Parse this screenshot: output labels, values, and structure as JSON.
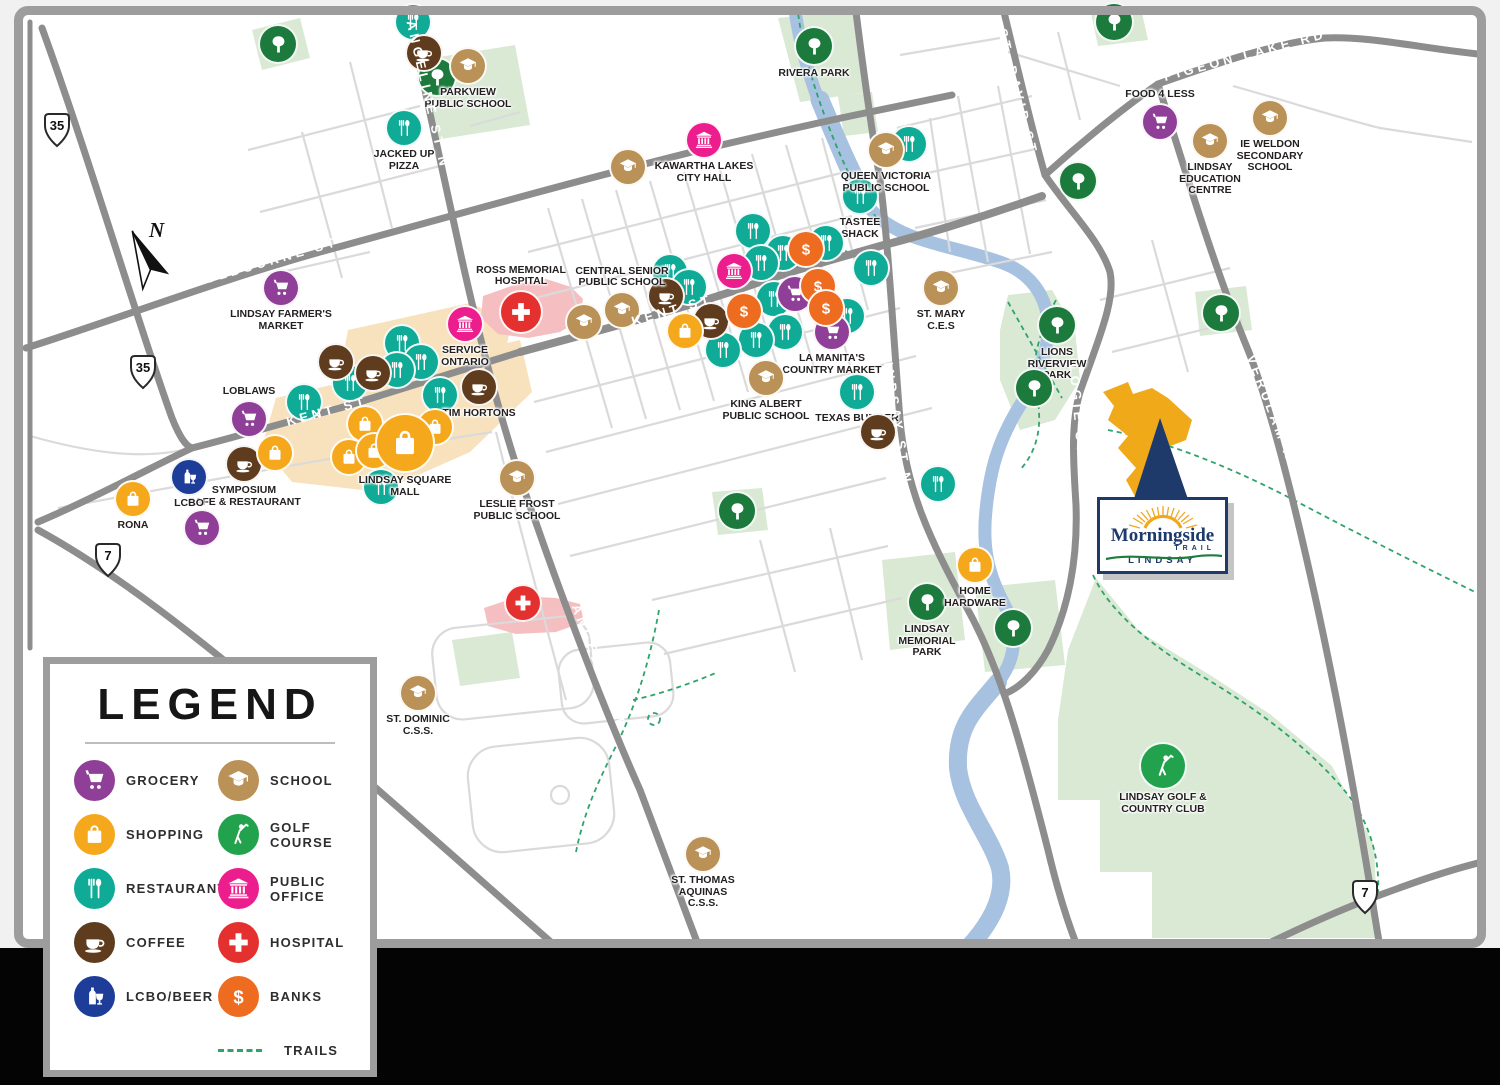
{
  "page": {
    "bottom_background": "black"
  },
  "legend": {
    "title": "LEGEND",
    "items": [
      {
        "type": "grocery",
        "label": "GROCERY"
      },
      {
        "type": "shopping",
        "label": "SHOPPING"
      },
      {
        "type": "restaurant",
        "label": "RESTAURANT"
      },
      {
        "type": "coffee",
        "label": "COFFEE"
      },
      {
        "type": "lcbo",
        "label": "LCBO/BEER"
      },
      {
        "type": "school",
        "label": "SCHOOL"
      },
      {
        "type": "golf",
        "label": "GOLF COURSE"
      },
      {
        "type": "public",
        "label": "PUBLIC OFFICE"
      },
      {
        "type": "hospital",
        "label": "HOSPITAL"
      },
      {
        "type": "bank",
        "label": "BANKS"
      }
    ],
    "trails_label": "TRAILS"
  },
  "logo": {
    "name": "Morningside",
    "trail": "TRAIL",
    "city": "LINDSAY"
  },
  "compass": {
    "label": "N"
  },
  "map": {
    "colors": {
      "grocery": "#8f3f97",
      "shopping": "#f6a81c",
      "restaurant": "#10ab97",
      "coffee": "#5f3c1d",
      "lcbo": "#1e3d98",
      "school": "#ba9156",
      "golf": "#22a24c",
      "public": "#ec1e8d",
      "hospital": "#e53030",
      "bank": "#ee6c1f",
      "park": "#1d7a3d",
      "trail": "#2fa36b",
      "river": "#a7c1e0",
      "park_fill": "#d9e9d4",
      "road_major": "#8d8d8d",
      "road_minor": "#dadada",
      "mall_fill": "#f7e2bd",
      "hospital_fill": "#f5bfc2",
      "logo_navy": "#1d3a6b",
      "logo_green": "#1e7c3e",
      "sun_orange": "#f2a71f",
      "parcel_orange": "#f0a919"
    },
    "shields": [
      {
        "n": "35",
        "x": 57,
        "y": 133
      },
      {
        "n": "35",
        "x": 143,
        "y": 375
      },
      {
        "n": "7",
        "x": 108,
        "y": 563
      },
      {
        "n": "7",
        "x": 1365,
        "y": 900
      }
    ],
    "road_labels": [
      {
        "text": "COLBOURNE ST",
        "x": 265,
        "y": 262,
        "rot": -16
      },
      {
        "text": "COLBOURNE ST",
        "x": 605,
        "y": 146,
        "rot": -14
      },
      {
        "text": "ANGELINE ST N",
        "x": 428,
        "y": 95,
        "rot": 77
      },
      {
        "text": "ANGELINE ST N",
        "x": 603,
        "y": 676,
        "rot": 69
      },
      {
        "text": "KENT ST",
        "x": 327,
        "y": 411,
        "rot": -15
      },
      {
        "text": "KENT ST",
        "x": 672,
        "y": 310,
        "rot": -16
      },
      {
        "text": "LINDSAY ST N",
        "x": 897,
        "y": 418,
        "rot": 81
      },
      {
        "text": "LINDSAY ST N",
        "x": 1026,
        "y": 808,
        "rot": 73
      },
      {
        "text": "ST. DAVID ST",
        "x": 1018,
        "y": 92,
        "rot": 76
      },
      {
        "text": "LOGIE ST",
        "x": 1078,
        "y": 410,
        "rot": 85
      },
      {
        "text": "PIGEON LAKE RD",
        "x": 1245,
        "y": 55,
        "rot": -15
      },
      {
        "text": "VERULAM RD S",
        "x": 1277,
        "y": 424,
        "rot": 69
      }
    ],
    "markers": [
      {
        "t": "park",
        "x": 278,
        "y": 44,
        "s": 36
      },
      {
        "t": "park",
        "x": 437,
        "y": 77,
        "s": 36
      },
      {
        "t": "park",
        "x": 814,
        "y": 46,
        "s": 36,
        "l": "RIVERA PARK",
        "lp": "below"
      },
      {
        "t": "park",
        "x": 1114,
        "y": 22,
        "s": 36
      },
      {
        "t": "park",
        "x": 1078,
        "y": 181,
        "s": 36
      },
      {
        "t": "park",
        "x": 1221,
        "y": 313,
        "s": 36
      },
      {
        "t": "park",
        "x": 1057,
        "y": 325,
        "s": 36,
        "l": "LIONS\nRIVERVIEW\nPARK",
        "lp": "below"
      },
      {
        "t": "park",
        "x": 1034,
        "y": 388,
        "s": 36
      },
      {
        "t": "park",
        "x": 737,
        "y": 511,
        "s": 36
      },
      {
        "t": "park",
        "x": 927,
        "y": 602,
        "s": 36,
        "l": "LINDSAY\nMEMORIAL\nPARK",
        "lp": "below"
      },
      {
        "t": "park",
        "x": 1013,
        "y": 628,
        "s": 36
      },
      {
        "t": "restaurant",
        "x": 413,
        "y": 22
      },
      {
        "t": "restaurant",
        "x": 404,
        "y": 128,
        "l": "JACKED UP\nPIZZA",
        "lp": "below"
      },
      {
        "t": "restaurant",
        "x": 909,
        "y": 144
      },
      {
        "t": "restaurant",
        "x": 860,
        "y": 196,
        "l": "TASTEE\nSHACK",
        "lp": "below"
      },
      {
        "t": "restaurant",
        "x": 753,
        "y": 231
      },
      {
        "t": "restaurant",
        "x": 826,
        "y": 243
      },
      {
        "t": "restaurant",
        "x": 871,
        "y": 268
      },
      {
        "t": "restaurant",
        "x": 783,
        "y": 253
      },
      {
        "t": "restaurant",
        "x": 761,
        "y": 263
      },
      {
        "t": "restaurant",
        "x": 670,
        "y": 272
      },
      {
        "t": "restaurant",
        "x": 689,
        "y": 287
      },
      {
        "t": "restaurant",
        "x": 774,
        "y": 299
      },
      {
        "t": "restaurant",
        "x": 847,
        "y": 316
      },
      {
        "t": "restaurant",
        "x": 785,
        "y": 332
      },
      {
        "t": "restaurant",
        "x": 756,
        "y": 340
      },
      {
        "t": "restaurant",
        "x": 723,
        "y": 350
      },
      {
        "t": "restaurant",
        "x": 938,
        "y": 484
      },
      {
        "t": "restaurant",
        "x": 857,
        "y": 392,
        "l": "TEXAS BURGER",
        "lp": "below"
      },
      {
        "t": "restaurant",
        "x": 402,
        "y": 343
      },
      {
        "t": "restaurant",
        "x": 421,
        "y": 362
      },
      {
        "t": "restaurant",
        "x": 397,
        "y": 370
      },
      {
        "t": "restaurant",
        "x": 350,
        "y": 383
      },
      {
        "t": "restaurant",
        "x": 304,
        "y": 402
      },
      {
        "t": "restaurant",
        "x": 440,
        "y": 395
      },
      {
        "t": "restaurant",
        "x": 381,
        "y": 487
      },
      {
        "t": "coffee",
        "x": 424,
        "y": 53
      },
      {
        "t": "coffee",
        "x": 336,
        "y": 362
      },
      {
        "t": "coffee",
        "x": 373,
        "y": 373
      },
      {
        "t": "coffee",
        "x": 666,
        "y": 296
      },
      {
        "t": "coffee",
        "x": 711,
        "y": 321
      },
      {
        "t": "coffee",
        "x": 479,
        "y": 387,
        "l": "TIM HORTONS",
        "lp": "below"
      },
      {
        "t": "coffee",
        "x": 244,
        "y": 464,
        "l": "SYMPOSIUM\nCAFE & RESTAURANT",
        "lp": "below"
      },
      {
        "t": "coffee",
        "x": 878,
        "y": 432
      },
      {
        "t": "grocery",
        "x": 281,
        "y": 288,
        "l": "LINDSAY FARMER'S\nMARKET",
        "lp": "below"
      },
      {
        "t": "grocery",
        "x": 249,
        "y": 419,
        "l": "LOBLAWS",
        "lp": "above"
      },
      {
        "t": "grocery",
        "x": 202,
        "y": 528
      },
      {
        "t": "grocery",
        "x": 1160,
        "y": 122,
        "l": "FOOD 4 LESS",
        "lp": "above"
      },
      {
        "t": "grocery",
        "x": 795,
        "y": 294
      },
      {
        "t": "grocery",
        "x": 832,
        "y": 332,
        "l": "LA MANITA'S\nCOUNTRY MARKET",
        "lp": "below"
      },
      {
        "t": "shopping",
        "x": 365,
        "y": 424
      },
      {
        "t": "shopping",
        "x": 275,
        "y": 453
      },
      {
        "t": "shopping",
        "x": 349,
        "y": 457
      },
      {
        "t": "shopping",
        "x": 374,
        "y": 451
      },
      {
        "t": "shopping",
        "x": 435,
        "y": 427
      },
      {
        "t": "shopping",
        "x": 405,
        "y": 443,
        "s": 56,
        "l": "LINDSAY SQUARE\nMALL",
        "lp": "below"
      },
      {
        "t": "shopping",
        "x": 685,
        "y": 331
      },
      {
        "t": "shopping",
        "x": 133,
        "y": 499,
        "l": "RONA",
        "lp": "below"
      },
      {
        "t": "shopping",
        "x": 975,
        "y": 565,
        "l": "HOME\nHARDWARE",
        "lp": "below"
      },
      {
        "t": "bank",
        "x": 806,
        "y": 249
      },
      {
        "t": "bank",
        "x": 818,
        "y": 286
      },
      {
        "t": "bank",
        "x": 826,
        "y": 308
      },
      {
        "t": "bank",
        "x": 744,
        "y": 311
      },
      {
        "t": "lcbo",
        "x": 189,
        "y": 477,
        "l": "LCBO",
        "lp": "below"
      },
      {
        "t": "school",
        "x": 468,
        "y": 66,
        "l": "PARKVIEW\nPUBLIC SCHOOL",
        "lp": "below"
      },
      {
        "t": "school",
        "x": 628,
        "y": 167
      },
      {
        "t": "school",
        "x": 886,
        "y": 150,
        "l": "QUEEN VICTORIA\nPUBLIC SCHOOL",
        "lp": "below"
      },
      {
        "t": "school",
        "x": 1210,
        "y": 141,
        "l": "LINDSAY\nEDUCATION\nCENTRE",
        "lp": "below"
      },
      {
        "t": "school",
        "x": 1270,
        "y": 118,
        "l": "IE WELDON\nSECONDARY\nSCHOOL",
        "lp": "below"
      },
      {
        "t": "school",
        "x": 584,
        "y": 322
      },
      {
        "t": "school",
        "x": 622,
        "y": 310,
        "l": "CENTRAL SENIOR\nPUBLIC SCHOOL",
        "lp": "above"
      },
      {
        "t": "school",
        "x": 941,
        "y": 288,
        "l": "ST. MARY\nC.E.S",
        "lp": "below"
      },
      {
        "t": "school",
        "x": 766,
        "y": 378,
        "l": "KING ALBERT\nPUBLIC SCHOOL",
        "lp": "below"
      },
      {
        "t": "school",
        "x": 517,
        "y": 478,
        "l": "LESLIE FROST\nPUBLIC SCHOOL",
        "lp": "below"
      },
      {
        "t": "school",
        "x": 418,
        "y": 693,
        "l": "ST. DOMINIC\nC.S.S.",
        "lp": "below"
      },
      {
        "t": "school",
        "x": 703,
        "y": 854,
        "l": "ST. THOMAS\nAQUINAS\nC.S.S.",
        "lp": "below"
      },
      {
        "t": "public",
        "x": 704,
        "y": 140,
        "l": "KAWARTHA LAKES\nCITY HALL",
        "lp": "below"
      },
      {
        "t": "public",
        "x": 465,
        "y": 324,
        "l": "SERVICE\nONTARIO",
        "lp": "below"
      },
      {
        "t": "public",
        "x": 734,
        "y": 271
      },
      {
        "t": "hospital",
        "x": 521,
        "y": 312,
        "s": 40,
        "l": "ROSS MEMORIAL\nHOSPITAL",
        "lp": "above"
      },
      {
        "t": "hospital",
        "x": 523,
        "y": 603
      },
      {
        "t": "golf",
        "x": 1163,
        "y": 766,
        "s": 44,
        "l": "LINDSAY GOLF &\nCOUNTRY CLUB",
        "lp": "below"
      }
    ]
  }
}
